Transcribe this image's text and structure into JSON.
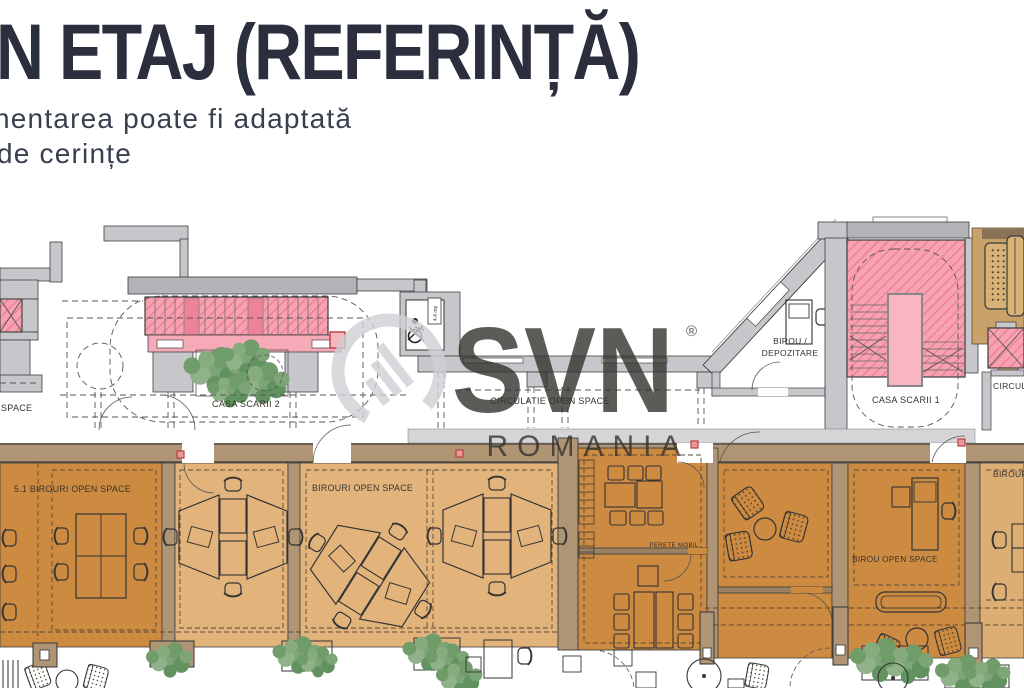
{
  "header": {
    "title": "N ETAJ (REFERINȚĂ)",
    "subtitle_line1": "nentarea poate fi adaptată",
    "subtitle_line2": "de cerințe"
  },
  "watermark": {
    "brand": "SVN",
    "registered": "®",
    "region": "ROMANIA"
  },
  "plan": {
    "labels": {
      "casa_scarii_2": "CASA SCARII 2",
      "casa_scarii_1": "CASA SCARII 1",
      "circulatie_open_space": "CIRCULATIE OPEN SPACE",
      "space_partial": "SPACE",
      "birou_depozitare_line1": "BIROU /",
      "birou_depozitare_line2": "DEPOZITARE",
      "circulatie_partial": "CIRCULATIE",
      "birouri_51": "5.1 BIROURI OPEN SPACE",
      "birouri_open_space": "BIROURI OPEN SPACE",
      "perete_mobil": "PERETE MOBIL",
      "birou_open_space": "BIROU OPEN SPACE",
      "birouri_partial": "BIROURI OPEN SPACE",
      "lift_area": "4.4 mp"
    },
    "colors": {
      "title_navy": "#2a2e3d",
      "wall_gray": "#c7c7cb",
      "wall_dark_gray": "#b3b3b7",
      "wall_tan": "#b09575",
      "stair_pink": "#f7a2b1",
      "room_dark_orange": "#cd8b42",
      "room_light_orange": "#e2b47c",
      "sofa_tan": "#d7b176",
      "plant_green": "#7da577",
      "marker_red": "#b84040",
      "watermark_gray": "#ced0d4"
    }
  }
}
